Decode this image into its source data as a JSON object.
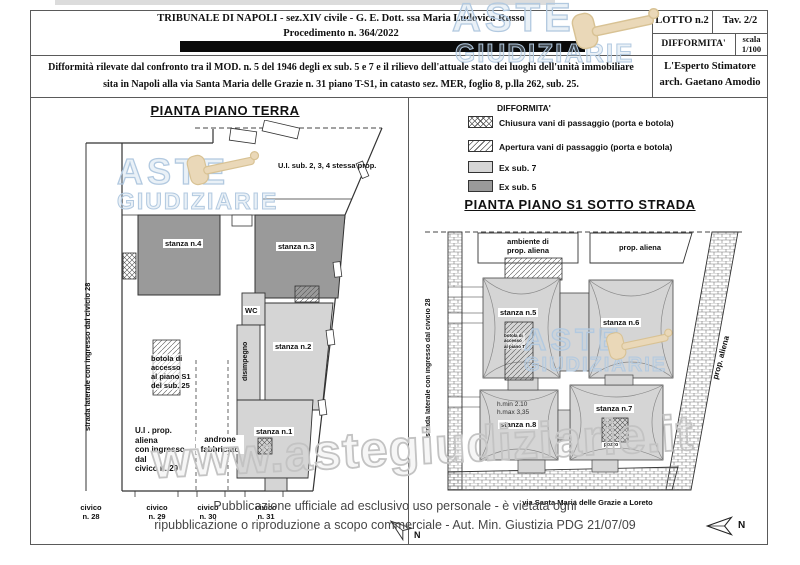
{
  "header": {
    "court": "TRIBUNALE  DI  NAPOLI   - sez.XIV civile  -  G. E. Dott. ssa Maria Ludovica Russo",
    "procedure": "Procedimento n. 364/2022",
    "lotto": "LOTTO n.2",
    "tav": "Tav. 2/2",
    "difformita": "DIFFORMITA'",
    "scala_line1": "scala",
    "scala_line2": "1/100",
    "desc1": "Difformità rilevate dal confronto tra il MOD. n. 5 del 1946 degli ex sub. 5 e 7 e il rilievo dell'attuale stato dei luoghi dell'unità immobiliare",
    "desc2": "sita in Napoli alla via Santa Maria delle Grazie n. 31 piano T-S1, in catasto sez. MER, foglio 8, p.lla 262, sub.  25.",
    "expert1": "L'Esperto Stimatore",
    "expert2": "arch. Gaetano Amodio"
  },
  "legend": {
    "title": "DIFFORMITA'",
    "items": [
      {
        "label": "Chiusura vani di passaggio (porta e botola)",
        "swatch": "crosshatch"
      },
      {
        "label": "Apertura vani di passaggio (porta e botola)",
        "swatch": "diagonal"
      },
      {
        "label": "Ex sub. 7",
        "swatch": "#d5d5d5"
      },
      {
        "label": "Ex sub. 5",
        "swatch": "#9a9a9a"
      }
    ]
  },
  "plan_terra": {
    "title": "PIANTA PIANO TERRA",
    "ui_sub": "U.I.  sub. 2, 3, 4 stessa prop.",
    "stanza4": "stanza n.4",
    "stanza3": "stanza n.3",
    "stanza2": "stanza n.2",
    "stanza1": "stanza n.1",
    "wc": "WC",
    "disimpegno": "disimpegno",
    "botola": "botola di\naccesso\nal piano S1\ndel sub. 25",
    "ui_aliena": "U.I . prop. aliena\ncon ingresso dal\ncivico n. 29",
    "androne": "androne\nfabbricato",
    "street": "strada laterale con ingresso dal civicio 28",
    "civici": [
      "civico\nn. 28",
      "civico\nn. 29",
      "civico\nn. 30",
      "civico\nn. 31"
    ],
    "north": "N"
  },
  "plan_s1": {
    "title": "PIANTA PIANO  S1  SOTTO STRADA",
    "ambiente": "ambiente di\nprop. aliena",
    "prop_aliena_top": "prop. aliena",
    "prop_aliena_side": "prop. aliena",
    "stanza5": "stanza n.5",
    "stanza6": "stanza n.6",
    "stanza7": "stanza n.7",
    "stanza8": "stanza n.8",
    "heights": "h.min 2.10\nh.max 3,35",
    "botola_small": "botola di\naccesso\nal piano T",
    "pozzo": "pozzo",
    "street": "strada laterale con ingresso dal civicio 28",
    "via": "via Santa Maria delle Grazie a Loreto",
    "north": "N"
  },
  "watermarks": {
    "aste": "ASTE",
    "giudiziarie": "GIUDIZIARIE",
    "url": "www.astegiudiziarie.it",
    "blue": "#b2c9e0",
    "gavel_tan": "#ead8b8"
  },
  "footer": {
    "line1": "Pubblicazione ufficiale ad esclusivo uso personale - è vietata ogni",
    "line2": "ripubblicazione o riproduzione a scopo commerciale - Aut. Min. Giustizia PDG 21/07/09"
  },
  "colors": {
    "ex_sub_7": "#d5d5d5",
    "ex_sub_5": "#9a9a9a",
    "border": "#5a5a5a",
    "redaction": "#0a0a0a"
  }
}
